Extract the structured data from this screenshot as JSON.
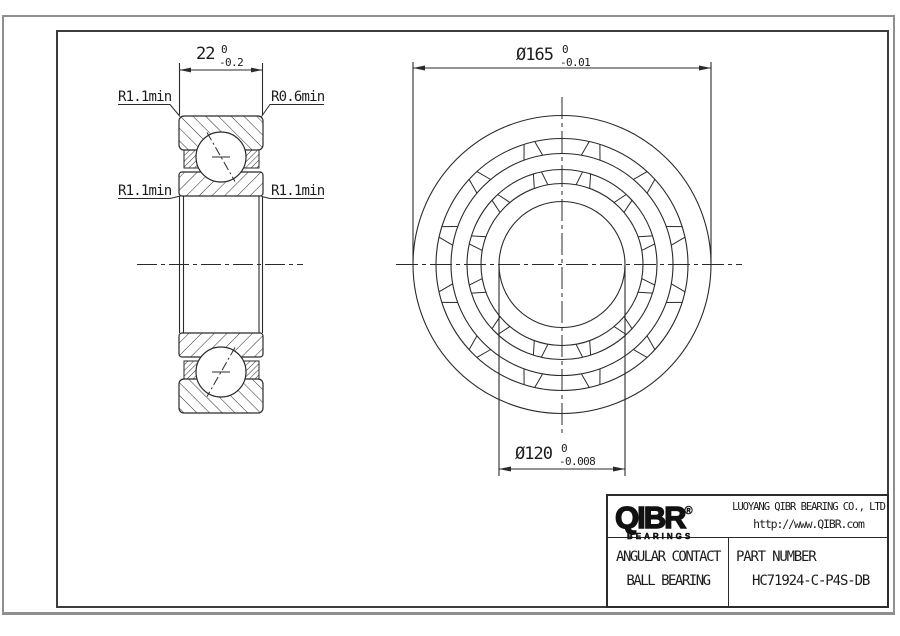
{
  "drawing": {
    "section_view": {
      "width_dim": {
        "value": "22",
        "tol_upper": "0",
        "tol_lower": "-0.2"
      },
      "radius_labels": {
        "top_left": "R1.1min",
        "top_right": "R0.6min",
        "mid_left": "R1.1min",
        "mid_right": "R1.1min"
      }
    },
    "front_view": {
      "outer_dia_dim": {
        "value": "Ø165",
        "tol_upper": "0",
        "tol_lower": "-0.01"
      },
      "bore_dia_dim": {
        "value": "Ø120",
        "tol_upper": "0",
        "tol_lower": "-0.008"
      }
    }
  },
  "title_block": {
    "logo_text": "QIBR",
    "logo_reg": "®",
    "logo_subtext": "BEARINGS",
    "company_name": "LUOYANG QIBR BEARING CO., LTD",
    "website": "http://www.QIBR.com",
    "product_line1": "ANGULAR CONTACT",
    "product_line2": "BALL BEARING",
    "part_number_label": "PART NUMBER",
    "part_number": "HC71924-C-P4S-DB"
  },
  "colors": {
    "line": "#2a2a2a",
    "frame_outer": "#8f8f8f",
    "frame_inner": "#3c3c3c"
  }
}
